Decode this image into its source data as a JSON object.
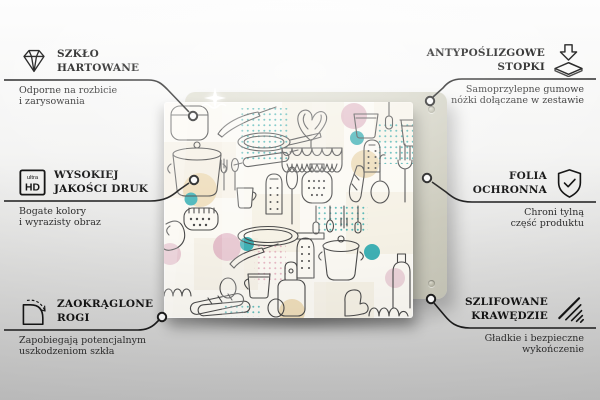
{
  "page": {
    "type": "product-feature-infographic",
    "language": "pl",
    "background_top": "#fdfdfd",
    "background_bottom": "#c8c8c8"
  },
  "product": {
    "description": "glass kitchen board with line-art kitchen utensil doodle pattern",
    "board_back_color": "#d6d5c7",
    "pattern_line_color": "#4a4a4a",
    "accent_colors": {
      "teal": "#3fb0b4",
      "pink": "#dfb5c3",
      "beige": "#ecd9b4",
      "cream": "#f0e9d8"
    }
  },
  "callout_style": {
    "line_color": "#1c1c1c",
    "text_color": "#151515"
  },
  "features": [
    {
      "id": "szklo-hartowane",
      "side": "left",
      "icon": "diamond-icon",
      "title1": "SZKŁO",
      "title2": "HARTOWANE",
      "sub1": "Odporne na rozbicie",
      "sub2": "i zarysowania"
    },
    {
      "id": "wysokiej-jakosci-druk",
      "side": "left",
      "icon": "ultra-hd-icon",
      "title1": "WYSOKIEJ",
      "title2": "JAKOŚCI DRUK",
      "sub1": "Bogate kolory",
      "sub2": "i wyrazisty obraz"
    },
    {
      "id": "zaokraglone-rogi",
      "side": "left",
      "icon": "rounded-corner-icon",
      "title1": "ZAOKRĄGLONE",
      "title2": "ROGI",
      "sub1": "Zapobiegają potencjalnym",
      "sub2": "uszkodzeniom szkła"
    },
    {
      "id": "antyposlizgowe-stopki",
      "side": "right",
      "icon": "anti-slip-feet-icon",
      "title1": "ANTYPOŚLIZGOWE",
      "title2": "STOPKI",
      "sub1": "Samoprzylepne gumowe",
      "sub2": "nóżki dołączane w zestawie"
    },
    {
      "id": "folia-ochronna",
      "side": "right",
      "icon": "shield-check-icon",
      "title1": "FOLIA",
      "title2": "OCHRONNA",
      "sub1": "Chroni tylną",
      "sub2": "część produktu"
    },
    {
      "id": "szlifowane-krawedzie",
      "side": "right",
      "icon": "polished-edges-icon",
      "title1": "SZLIFOWANE",
      "title2": "KRAWĘDZIE",
      "sub1": "Gładkie i bezpieczne",
      "sub2": "wykończenie"
    }
  ],
  "icons": {
    "ultra_hd": {
      "top": "ultra",
      "bottom": "HD"
    }
  }
}
